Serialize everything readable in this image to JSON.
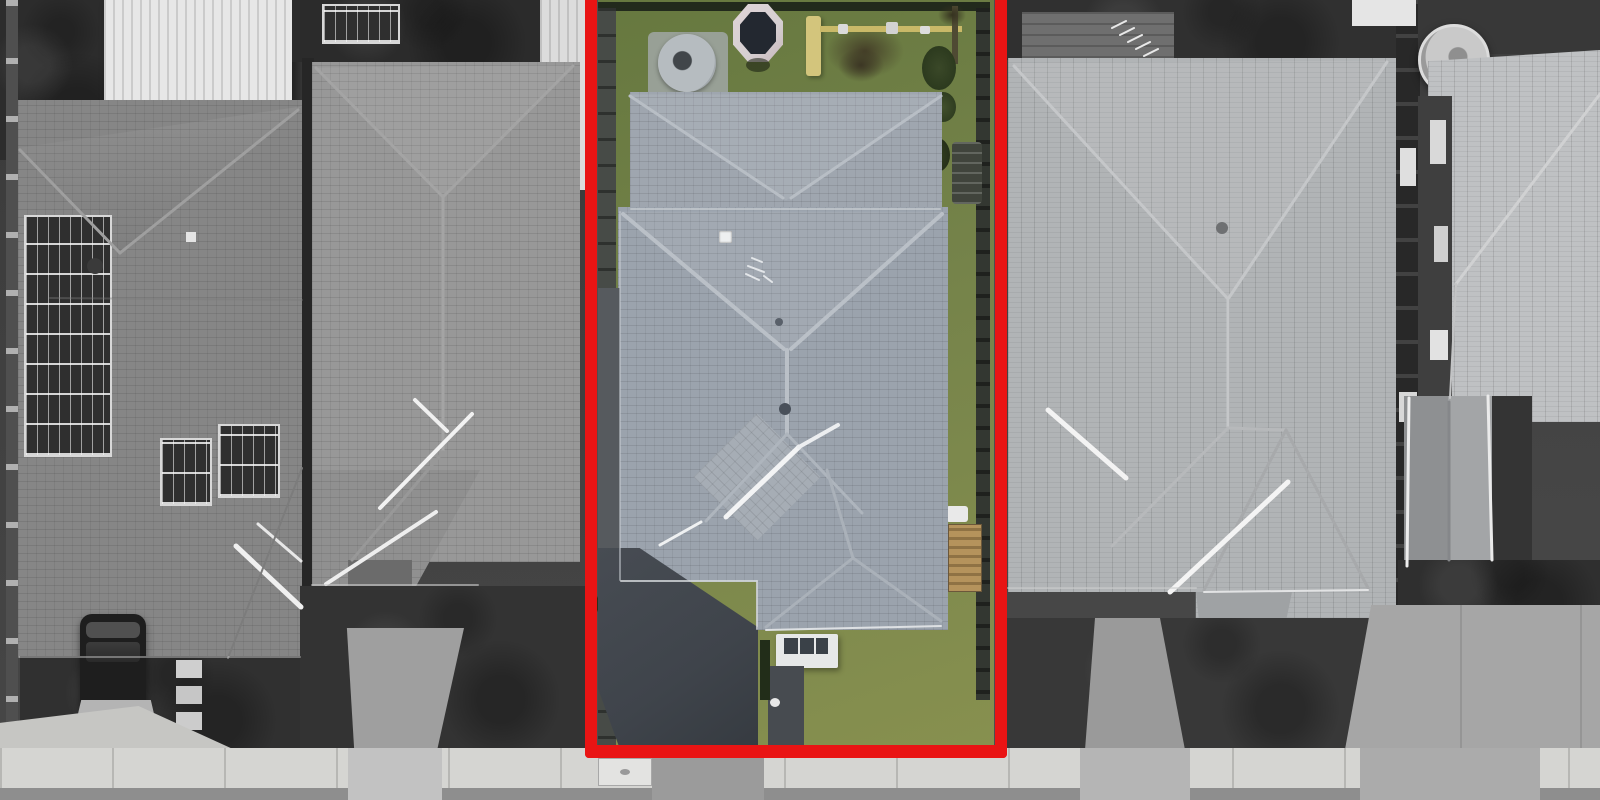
{
  "scene": {
    "type": "aerial-drone-photograph",
    "description": "Top-down aerial view of a suburban street. The subject property is outlined with a thick red boundary and shown in colour; all neighbouring properties, footpath and road are desaturated greyscale.",
    "highlighted_property": {
      "boundary_color": "#e91414",
      "features": [
        "grey-blue tiled hip roof main dwelling",
        "secondary hip roof over rear garage/rumpus",
        "green backyard lawn",
        "trampoline with dark mat and pale padded ring",
        "timber play set with slide, swing beam and worn dirt patch",
        "round rainwater tank on pad",
        "front porch with white frame",
        "dark concrete driveway and side path",
        "timber garden bench along side fence",
        "shrubs and palms along fence lines",
        "front lawn"
      ]
    },
    "neighbours": {
      "far_left_house": [
        "dark tiled hip roof",
        "rooftop solar panel arrays",
        "white corrugated shed roof",
        "dark SUV parked on driveway",
        "stepping stones",
        "dark front garden"
      ],
      "near_left_house": [
        "grey tiled hip roof with long centre ridge",
        "white car parked beside garage",
        "driveway to street",
        "white corrugated side structure"
      ],
      "near_right_house": [
        "large light-grey tiled hip roof",
        "roof vent",
        "white ridge capping",
        "front porch",
        "driveway crossover",
        "dark front garden",
        "rear timber deck with ladder"
      ],
      "far_right_house": [
        "round rainwater tank",
        "gabled garage roof",
        "narrow side alley with windows and AC units",
        "large concrete driveway"
      ]
    },
    "street_elements": [
      "concrete footpath with expansion joints",
      "asphalt road along bottom edge",
      "five driveway crossovers",
      "utility pit cover in footpath"
    ]
  },
  "palette": {
    "red_border": "#e91414",
    "grass_a": "#66783f",
    "grass_b": "#75834a",
    "grass_c": "#87904f",
    "roof_main": "#9ba3ad",
    "roof_rear": "#9fa6af",
    "roof_diamond": "#a6adb5",
    "driveway_dark": "#3f444b",
    "path_grey": "#565a5e",
    "trampoline_ring": "#d6d0d2",
    "trampoline_mat": "#232830",
    "play_tan": "#d3c57c",
    "beam_tan": "#c9b968",
    "soil_brown": "#453f28",
    "tank_grey": "#b6bcc0",
    "porch_white": "#e6e8e8",
    "porch_glass": "#3a4148",
    "hedge_green": "#222d19",
    "foliage_dark": "#33401f",
    "bench_timber": "#b5935c",
    "fence_dark": "#474b47",
    "fence_line": "#222a1c",
    "left_roof": "#868686",
    "mid_roof": "#989898",
    "right_roof": "#b1b4b6",
    "far_roof": "#bfc1c3",
    "garage_gable": "#8e9092",
    "shed_white": "#e7e7e7",
    "ground_dark": "#2c2c2c",
    "garden_dark": "#333333",
    "sidewalk": "#d5d5d2",
    "street": "#8e8e8e",
    "concrete_light": "#a6a6a6",
    "car_white": "#ececec",
    "car_dark": "#1e1e1e",
    "solar_dark": "#2f2f2f",
    "deck_grey": "#6f6f6f"
  }
}
